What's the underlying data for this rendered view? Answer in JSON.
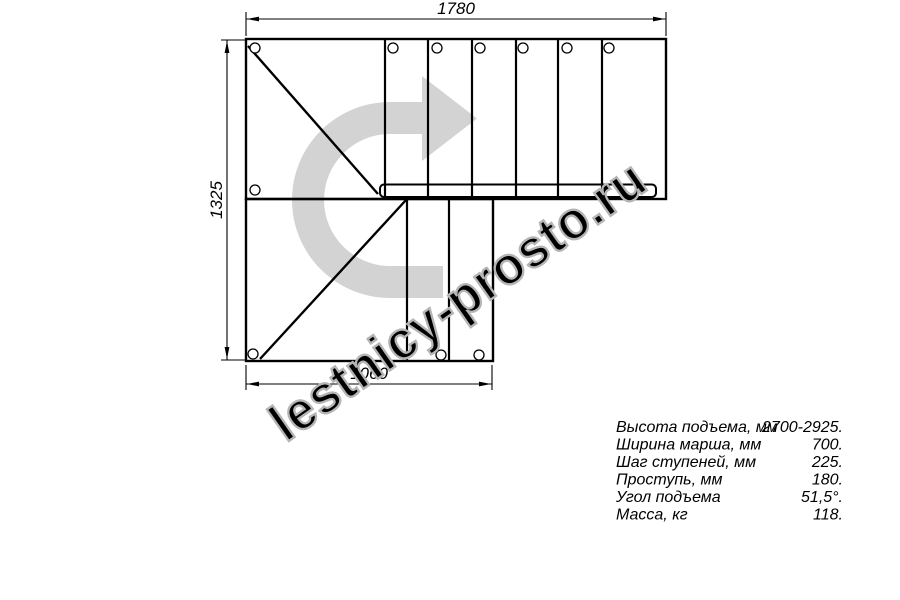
{
  "drawing": {
    "type": "stair-plan-top-view",
    "dimensions": {
      "top_width": "1780",
      "left_height": "1325",
      "bottom_width": "1060"
    }
  },
  "specs": {
    "rows": [
      {
        "label": "Высота подъема, мм",
        "value": "2700-2925."
      },
      {
        "label": "Ширина марша, мм",
        "value": "700."
      },
      {
        "label": "Шаг ступеней, мм",
        "value": "225."
      },
      {
        "label": "Проступь, мм",
        "value": "180."
      },
      {
        "label": "Угол подъема",
        "value": "51,5°."
      },
      {
        "label": "Масса, кг",
        "value": "118."
      }
    ]
  },
  "watermark": {
    "text": "lestnicy-prosto.ru"
  },
  "icons": {
    "direction_arrow": "u-turn-right-arrow"
  },
  "colors": {
    "line": "#000000",
    "arrow_fill": "#d3d3d3",
    "watermark_stroke": "#b5b5b5",
    "watermark_fill": "rgba(255,255,255,0.72)"
  }
}
